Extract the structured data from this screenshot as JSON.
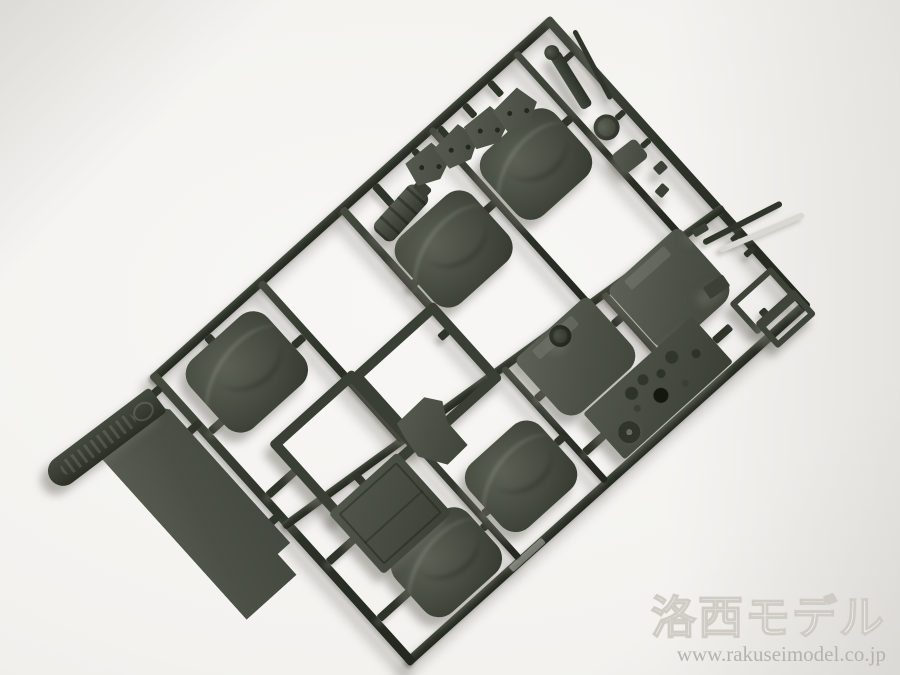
{
  "scene": {
    "alt": "Photograph of an injection-molded plastic model sprue in olive-drab plastic on a white background: seat cushions, seat backs, floor panel, seat frames, engine cover, instrument panel and small fittings still attached to the runner frame.",
    "colors": {
      "plastic_dark": "#2f342b",
      "plastic_mid": "#4a4f44",
      "plastic_light": "#5b6054",
      "plastic_highlight": "#464b40",
      "background": "#f3f2ef",
      "watermark_gray": "#b5b3ae"
    }
  },
  "watermark": {
    "title": "洛西モデル",
    "url": "www.rakuseimodel.co.jp"
  },
  "sprue": {
    "rotation_deg": -42,
    "rails": [
      {
        "name": "sprue-rail-top",
        "x": 0,
        "y": 0,
        "w": 540,
        "h": 9
      },
      {
        "name": "sprue-rail-bottom",
        "x": 0,
        "y": 381,
        "w": 540,
        "h": 9
      },
      {
        "name": "sprue-rail-left",
        "x": 0,
        "y": 0,
        "w": 9,
        "h": 390
      },
      {
        "name": "sprue-rail-right",
        "x": 531,
        "y": 0,
        "w": 9,
        "h": 390
      },
      {
        "name": "sprue-runner-middle",
        "x": -2,
        "y": 226,
        "w": 544,
        "h": 8,
        "rot": 6
      },
      {
        "name": "sprue-runner-v1",
        "x": 142,
        "y": 4,
        "w": 8,
        "h": 214
      },
      {
        "name": "sprue-runner-v2",
        "x": 252,
        "y": 4,
        "w": 8,
        "h": 226
      },
      {
        "name": "sprue-runner-v3",
        "x": 372,
        "y": 4,
        "w": 7,
        "h": 238
      },
      {
        "name": "sprue-runner-v4",
        "x": 486,
        "y": 4,
        "w": 7,
        "h": 250
      },
      {
        "name": "sprue-runner-v5",
        "x": 150,
        "y": 218,
        "w": 7,
        "h": 166
      },
      {
        "name": "sprue-runner-v6",
        "x": 266,
        "y": 230,
        "w": 7,
        "h": 154
      },
      {
        "name": "sprue-runner-v7",
        "x": 390,
        "y": 242,
        "w": 7,
        "h": 78
      }
    ],
    "stubs": [
      {
        "name": "gate-stub",
        "x": 66,
        "y": 9,
        "w": 9,
        "h": 12
      },
      {
        "name": "gate-stub",
        "x": 9,
        "y": 78,
        "w": 18,
        "h": 8
      },
      {
        "name": "gate-stub",
        "x": 128,
        "y": 70,
        "w": 14,
        "h": 8
      },
      {
        "name": "gate-stub",
        "x": 242,
        "y": 162,
        "w": 11,
        "h": 8
      },
      {
        "name": "gate-stub",
        "x": 9,
        "y": 164,
        "w": 36,
        "h": 8
      },
      {
        "name": "gate-stub",
        "x": 252,
        "y": 104,
        "w": 11,
        "h": 8
      },
      {
        "name": "gate-stub",
        "x": 360,
        "y": 98,
        "w": 13,
        "h": 8
      },
      {
        "name": "gate-stub",
        "x": 477,
        "y": 86,
        "w": 10,
        "h": 8
      },
      {
        "name": "gate-stub",
        "x": 345,
        "y": 9,
        "w": 7,
        "h": 12
      },
      {
        "name": "gate-stub",
        "x": 379,
        "y": 9,
        "w": 7,
        "h": 14
      },
      {
        "name": "gate-stub",
        "x": 413,
        "y": 9,
        "w": 7,
        "h": 16
      },
      {
        "name": "gate-stub",
        "x": 447,
        "y": 9,
        "w": 7,
        "h": 18
      },
      {
        "name": "gate-stub",
        "x": 292,
        "y": 9,
        "w": 8,
        "h": 26
      },
      {
        "name": "gate-stub",
        "x": -8,
        "y": 64,
        "w": 16,
        "h": 8
      },
      {
        "name": "gate-stub",
        "x": -8,
        "y": 186,
        "w": 16,
        "h": 8
      },
      {
        "name": "gate-stub",
        "x": -12,
        "y": 12,
        "w": 13,
        "h": 8
      },
      {
        "name": "gate-stub",
        "x": 84,
        "y": 210,
        "w": 8,
        "h": 14
      },
      {
        "name": "gate-stub",
        "x": 9,
        "y": 254,
        "w": 34,
        "h": 8
      },
      {
        "name": "gate-stub",
        "x": 9,
        "y": 330,
        "w": 40,
        "h": 8
      },
      {
        "name": "gate-stub",
        "x": 146,
        "y": 332,
        "w": 8,
        "h": 8
      },
      {
        "name": "gate-stub",
        "x": 157,
        "y": 322,
        "w": 8,
        "h": 8
      },
      {
        "name": "gate-stub",
        "x": 258,
        "y": 318,
        "w": 10,
        "h": 8
      },
      {
        "name": "gate-stub",
        "x": 273,
        "y": 272,
        "w": 10,
        "h": 8
      },
      {
        "name": "gate-stub",
        "x": 380,
        "y": 268,
        "w": 11,
        "h": 8
      },
      {
        "name": "gate-stub",
        "x": 273,
        "y": 344,
        "w": 26,
        "h": 8
      },
      {
        "name": "gate-stub",
        "x": 444,
        "y": 348,
        "w": 22,
        "h": 8
      },
      {
        "name": "gate-stub",
        "x": 496,
        "y": 360,
        "w": 8,
        "h": 8
      },
      {
        "name": "gate-stub",
        "x": 524,
        "y": 286,
        "w": 12,
        "h": 6
      },
      {
        "name": "gate-stub",
        "x": 524,
        "y": 306,
        "w": 12,
        "h": 6
      },
      {
        "name": "gate-stub",
        "x": 518,
        "y": 40,
        "w": 14,
        "h": 6
      },
      {
        "name": "gate-stub",
        "x": 520,
        "y": 118,
        "w": 11,
        "h": 6
      },
      {
        "name": "gate-stub",
        "x": 520,
        "y": 156,
        "w": 11,
        "h": 6
      }
    ],
    "parts": [
      {
        "name": "seat-cushion-1",
        "type": "cushion",
        "x": 24,
        "y": 16,
        "w": 104,
        "h": 92
      },
      {
        "name": "seat-cushion-2",
        "type": "cushion",
        "x": 262,
        "y": 64,
        "w": 100,
        "h": 90
      },
      {
        "name": "seat-cushion-3",
        "type": "cushion",
        "x": 382,
        "y": 58,
        "w": 96,
        "h": 86
      },
      {
        "name": "seat-cushion-4",
        "type": "cushion",
        "x": 48,
        "y": 296,
        "w": 98,
        "h": 82
      },
      {
        "name": "seat-cushion-5",
        "type": "cushion",
        "x": 162,
        "y": 280,
        "w": 96,
        "h": 86
      },
      {
        "name": "seat-back-1",
        "type": "seatback",
        "x": 398,
        "y": 242,
        "w": 96,
        "h": 88
      },
      {
        "name": "seat-back-2",
        "type": "seatback",
        "x": 282,
        "y": 232,
        "w": 98,
        "h": 84
      },
      {
        "name": "floor-panel",
        "type": "panel",
        "x": -90,
        "y": 30,
        "w": 84,
        "h": 216
      },
      {
        "name": "sprue-tag",
        "type": "tag",
        "x": -142,
        "y": 2,
        "w": 134,
        "h": 30,
        "rot": 5
      },
      {
        "name": "seat-frame-1",
        "type": "sqframe",
        "x": 150,
        "y": 134,
        "w": 92,
        "h": 84
      },
      {
        "name": "seat-frame-2",
        "type": "sqframe",
        "x": 44,
        "y": 130,
        "w": 92,
        "h": 84
      },
      {
        "name": "engine-cover",
        "type": "box",
        "x": 42,
        "y": 222,
        "w": 92,
        "h": 82
      },
      {
        "name": "fender-bracket",
        "type": "mudguard",
        "x": 146,
        "y": 198,
        "w": 58,
        "h": 68,
        "rot": -8
      },
      {
        "name": "instrument-panel",
        "type": "dashboard",
        "x": 298,
        "y": 318,
        "w": 146,
        "h": 62
      },
      {
        "name": "pedal-frame-1",
        "type": "smframe",
        "x": 480,
        "y": 334,
        "w": 44,
        "h": 30
      },
      {
        "name": "pedal-frame-2",
        "type": "smframe",
        "x": 486,
        "y": 366,
        "w": 40,
        "h": 22
      },
      {
        "name": "small-block-1",
        "type": "bit",
        "x": 470,
        "y": 306,
        "w": 24,
        "h": 14,
        "rot": 8
      },
      {
        "name": "center-gate-boss",
        "type": "boss",
        "x": 322,
        "y": 234,
        "w": 22,
        "h": 22
      },
      {
        "name": "fire-extinguisher",
        "type": "cylinder",
        "x": 266,
        "y": 34,
        "w": 62,
        "h": 26,
        "rot": -6
      },
      {
        "name": "mount-bracket-1",
        "type": "bracket",
        "x": 328,
        "y": 14,
        "w": 42,
        "h": 34,
        "rot": 3
      },
      {
        "name": "mount-bracket-2",
        "type": "bracket",
        "x": 362,
        "y": 20,
        "w": 42,
        "h": 34,
        "rot": -4
      },
      {
        "name": "mount-bracket-3",
        "type": "bracket",
        "x": 396,
        "y": 26,
        "w": 42,
        "h": 34,
        "rot": 3
      },
      {
        "name": "mount-bracket-4",
        "type": "bracket",
        "x": 430,
        "y": 32,
        "w": 42,
        "h": 34,
        "rot": -3
      },
      {
        "name": "gear-lever",
        "type": "lever",
        "x": 506,
        "y": 30,
        "w": 12,
        "h": 64,
        "rot": 10
      },
      {
        "name": "steering-boss",
        "type": "knob",
        "x": 494,
        "y": 108,
        "w": 26,
        "h": 26
      },
      {
        "name": "access-flap",
        "type": "flap",
        "x": 490,
        "y": 146,
        "w": 30,
        "h": 24,
        "rot": 4
      },
      {
        "name": "small-block-2",
        "type": "bit",
        "x": 514,
        "y": 182,
        "w": 12,
        "h": 10
      },
      {
        "name": "small-block-3",
        "type": "bit",
        "x": 500,
        "y": 200,
        "w": 12,
        "h": 10,
        "rot": -6
      },
      {
        "name": "small-block-4",
        "type": "bit",
        "x": 500,
        "y": 256,
        "w": 16,
        "h": 8,
        "rot": 12
      },
      {
        "name": "wiper-blade-1",
        "type": "rod",
        "x": 500,
        "y": 280,
        "w": 88,
        "h": 6,
        "rot": 15
      },
      {
        "name": "wiper-blade-2",
        "type": "rodlight",
        "x": 506,
        "y": 300,
        "w": 92,
        "h": 6,
        "rot": 19
      },
      {
        "name": "antenna-rod",
        "type": "rod",
        "x": 536,
        "y": 26,
        "w": 5,
        "h": 78,
        "rot": 14
      },
      {
        "name": "embossed-marking",
        "type": "emboss",
        "x": 140,
        "y": 382,
        "w": 44,
        "h": 7
      }
    ]
  }
}
